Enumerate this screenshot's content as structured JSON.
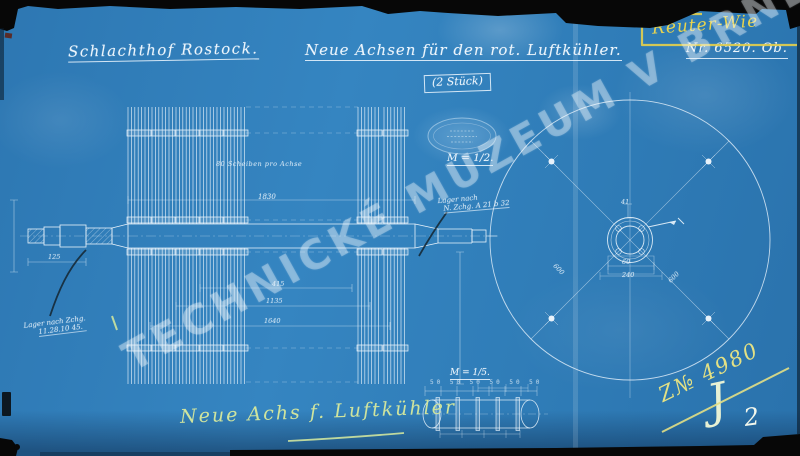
{
  "watermark": {
    "text": "TECHNICKÉ MUZEUM V BRNĚ"
  },
  "header": {
    "client": "Schlachthof Rostock.",
    "title": "Neue Achsen für den rot. Luftkühler.",
    "quantity": "(2 Stück)",
    "maker_mark": "Reuter-Wie",
    "drawing_number": "Nr. 6520. Ob."
  },
  "notes": {
    "scale_main": "M = 1/2.",
    "scale_detail": "M = 1/5.",
    "disc_count": "80 Scheiben pro Achse",
    "bearing_left_line1": "Lager nach Zchg.",
    "bearing_left_line2": "11.28.10 45.",
    "bearing_mid_line1": "Lager nach",
    "bearing_mid_line2": "N. Zchg. A 21 b 32",
    "bottom_title": "Neue Achs f. Luftkühler"
  },
  "dimensions": {
    "overall_length": "1830",
    "dim_a": "415",
    "dim_b": "1135",
    "dim_c": "1640",
    "dim_shaft_end": "125",
    "hub_height": "41",
    "hub_width": "60",
    "hub_base": "240",
    "spoke_radius_left": "600",
    "spoke_radius_right": "600",
    "detail_ticks": "50 50 50 50 50 50"
  },
  "registry": {
    "inventory_number": "Z№ 4980",
    "sheet_letter": "J",
    "sheet_number": "2"
  },
  "colors": {
    "paper_blue": "#2f7cb7",
    "line_white": "#e9f3fb",
    "annotation_yellow": "#e8d44f",
    "pencil_green_yellow": "#cfe49e",
    "scan_black": "#0a0a0a"
  }
}
